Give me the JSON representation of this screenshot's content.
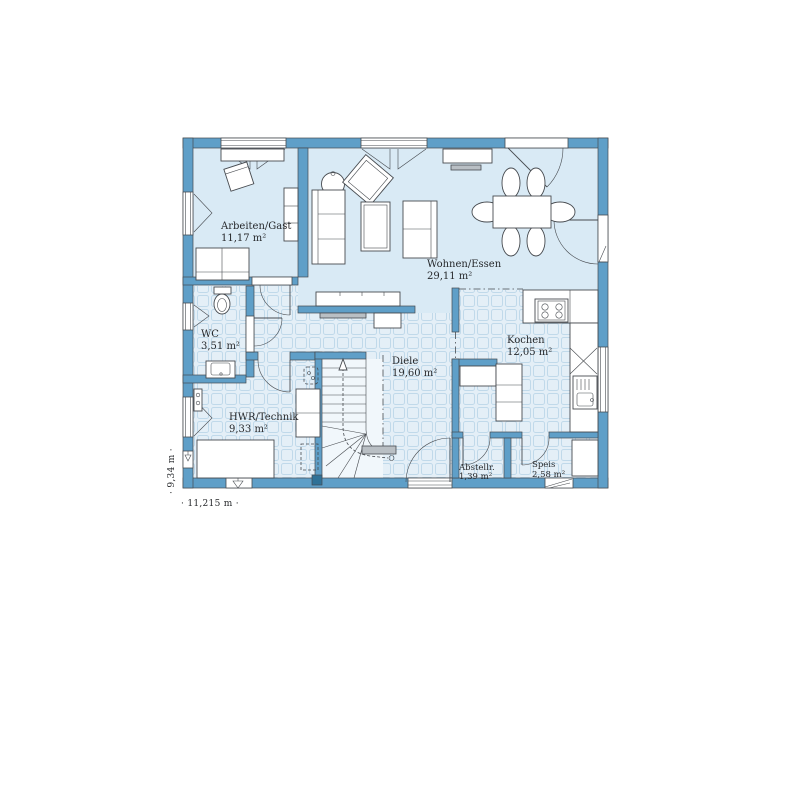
{
  "plan": {
    "title": "floor-plan",
    "rooms": [
      {
        "name": "Arbeiten/Gast",
        "area": "11,17 m²"
      },
      {
        "name": "Wohnen/Essen",
        "area": "29,11 m²"
      },
      {
        "name": "Kochen",
        "area": "12,05 m²"
      },
      {
        "name": "Diele",
        "area": "19,60 m²"
      },
      {
        "name": "WC",
        "area": "3,51 m²"
      },
      {
        "name": "HWR/Technik",
        "area": "9,33 m²"
      },
      {
        "name": "Abstellr.",
        "area": "1,39 m²"
      },
      {
        "name": "Speis",
        "area": "2,58 m²"
      }
    ],
    "dimensions": {
      "height_label": "· 9,34 m ·",
      "width_label": "· 11,215 m ·"
    },
    "colors": {
      "wall": "#5f9fc8",
      "post": "#2f7197",
      "floor": "#d9eaf5",
      "tile_bg": "#e4eff7",
      "tile_line": "#c0d9ea",
      "stairfloor": "#f1f7fb",
      "bench": "#b9bfc4",
      "line": "#474b50",
      "text": "#26282b"
    }
  }
}
